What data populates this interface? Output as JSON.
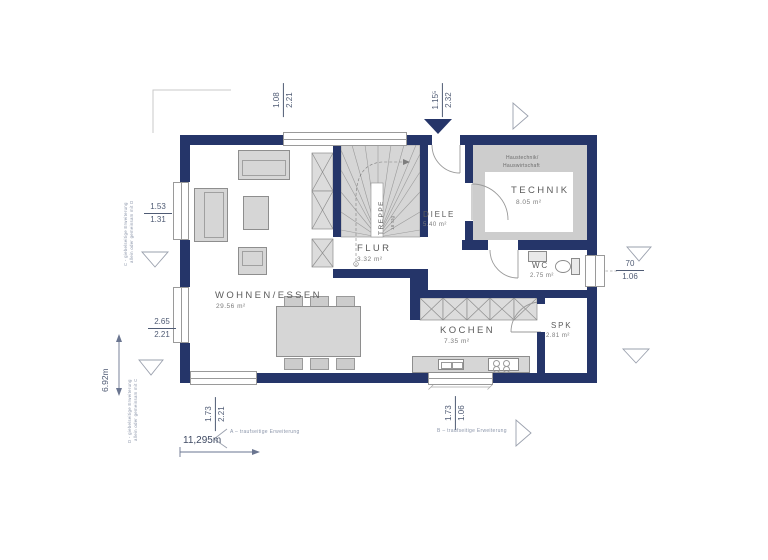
{
  "colors": {
    "wall": "#253569",
    "furniture": "#d6d6d6",
    "floor_gray": "#cdcdcd",
    "dim_text": "#4f5b74"
  },
  "rooms": {
    "wohnen": {
      "name": "WOHNEN/ESSEN",
      "area": "29.56 m²"
    },
    "flur": {
      "name": "FLUR",
      "area": "3.32 m²"
    },
    "treppe": {
      "name": "TREPPE",
      "steps": "18 Stg"
    },
    "diele": {
      "name": "DIELE",
      "area": "5.40 m²"
    },
    "technik": {
      "name": "TECHNIK",
      "area": "8.05 m²",
      "note_line1": "Haustechnik/",
      "note_line2": "Hauswirtschaft"
    },
    "wc": {
      "name": "WC",
      "area": "2.75 m²"
    },
    "kochen": {
      "name": "KOCHEN",
      "area": "7.35 m²"
    },
    "spk": {
      "name": "SPK",
      "area": "2.81 m²"
    }
  },
  "dimensions": {
    "top_left": {
      "num": "1.08",
      "den": "2.21"
    },
    "top_right": {
      "num": "1.15⁵",
      "den": "2.32"
    },
    "left_upper": {
      "num": "1.53",
      "den": "1.31"
    },
    "left_lower": {
      "num": "2.65",
      "den": "2.21"
    },
    "right_mid": {
      "num": "70",
      "den": "1.06"
    },
    "bottom_left": {
      "num": "1.73",
      "den": "2.21"
    },
    "bottom_right": {
      "num": "1.73",
      "den": "1.06"
    },
    "total_depth": "6.92m",
    "total_width": "11,295m"
  },
  "annotations": {
    "a": "A – traufseitige Erweiterung",
    "b": "B – traufseitige Erweiterung",
    "c_line1": "C - giebelseitige Erweiterung",
    "c_line2": "allein oder gemeinsam mit D",
    "d_line1": "D - giebelseitige Erweiterung",
    "d_line2": "allein oder gemeinsam mit C"
  }
}
